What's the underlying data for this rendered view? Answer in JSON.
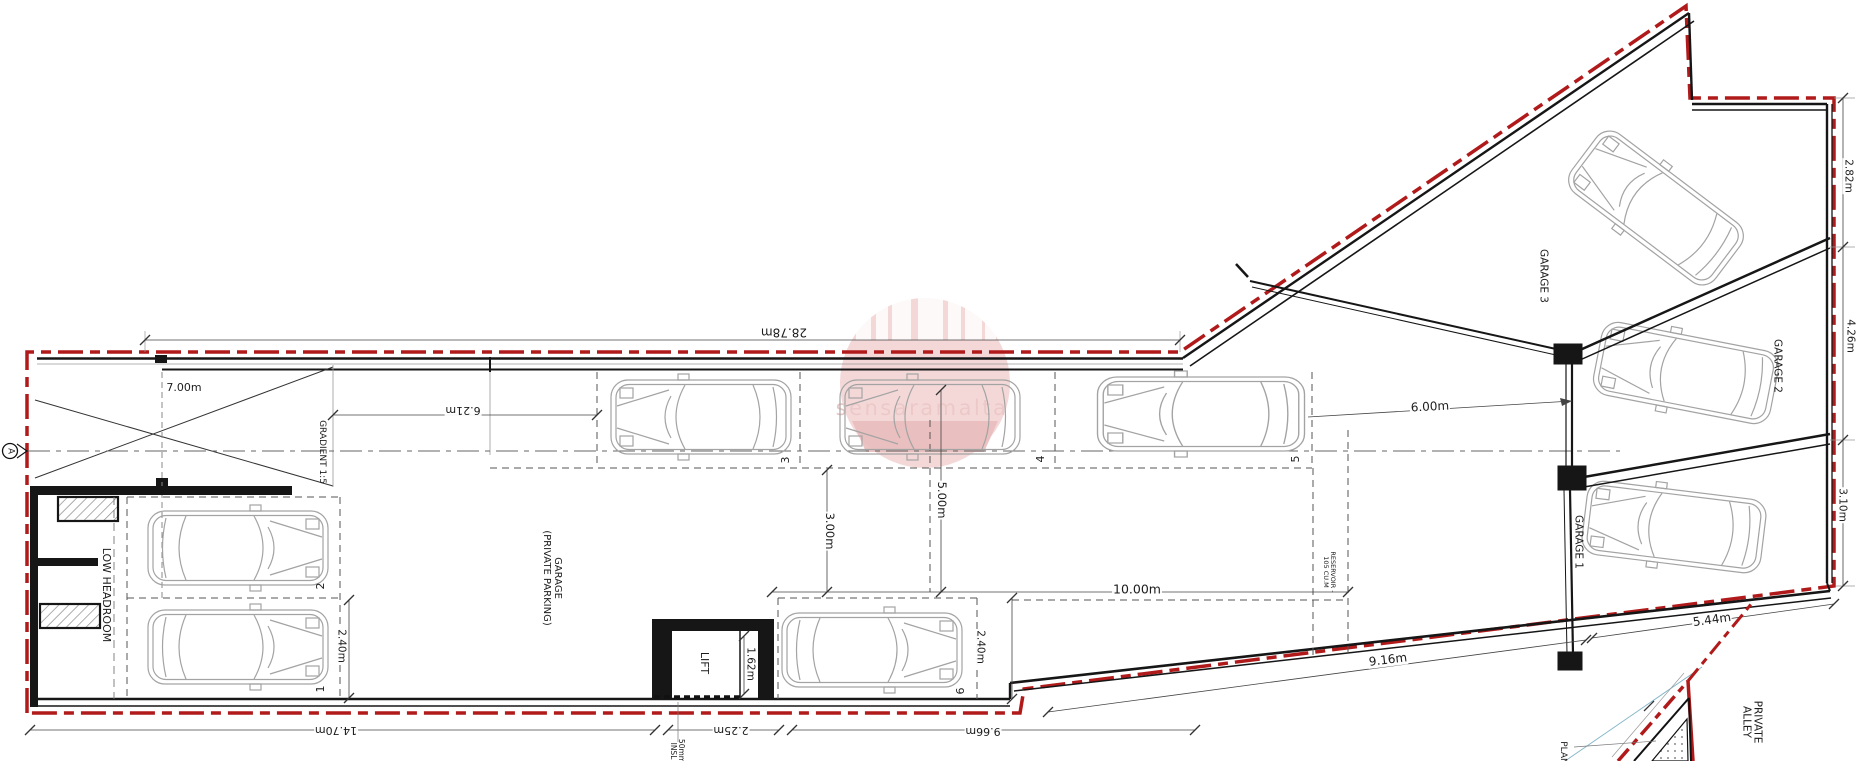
{
  "drawing": {
    "watermark": {
      "text": "sensaramalta"
    },
    "section_marker": {
      "label": "A"
    },
    "areas": {
      "gradient": "GRADIENT 1:5",
      "low_headroom": "LOW HEADROOM",
      "garage_private": "GARAGE\n(PRIVATE PARKING)",
      "lift": "LIFT",
      "insl": "50mm\nINSL",
      "reservoir": "RESERVOIR -\n105 CU.M",
      "garage_1": "GARAGE 1",
      "garage_2": "GARAGE 2",
      "garage_3": "GARAGE 3",
      "private_alley": "PRIVATE\nALLEY",
      "plan_partial": "PLAN"
    },
    "parking_spaces": {
      "s1": "1",
      "s2": "2",
      "s3": "3",
      "s4": "4",
      "s5": "5",
      "s6": "6"
    },
    "dimensions": {
      "entrance_width": "7.00m",
      "top_boundary": "28.78m",
      "ramp_length": "6.21m",
      "bay_depth_3": "3.00m",
      "bay_depth_5": "5.00m",
      "aisle_length": "10.00m",
      "bay_width_left": "2.40m",
      "bay_width_right": "2.40m",
      "lift_shaft": "1.62m",
      "lift_outer": "2.25m",
      "bottom_left": "14.70m",
      "bottom_mid": "9.66m",
      "garage_front": "6.00m",
      "right_top": "2.82m",
      "right_mid": "4.26m",
      "right_bottom": "3.10m",
      "alley_upper": "5.44m",
      "alley_lower": "9.16m"
    },
    "colors": {
      "boundary_red": "#b11a1a",
      "watermark_pink": "#f0c9c9"
    }
  }
}
